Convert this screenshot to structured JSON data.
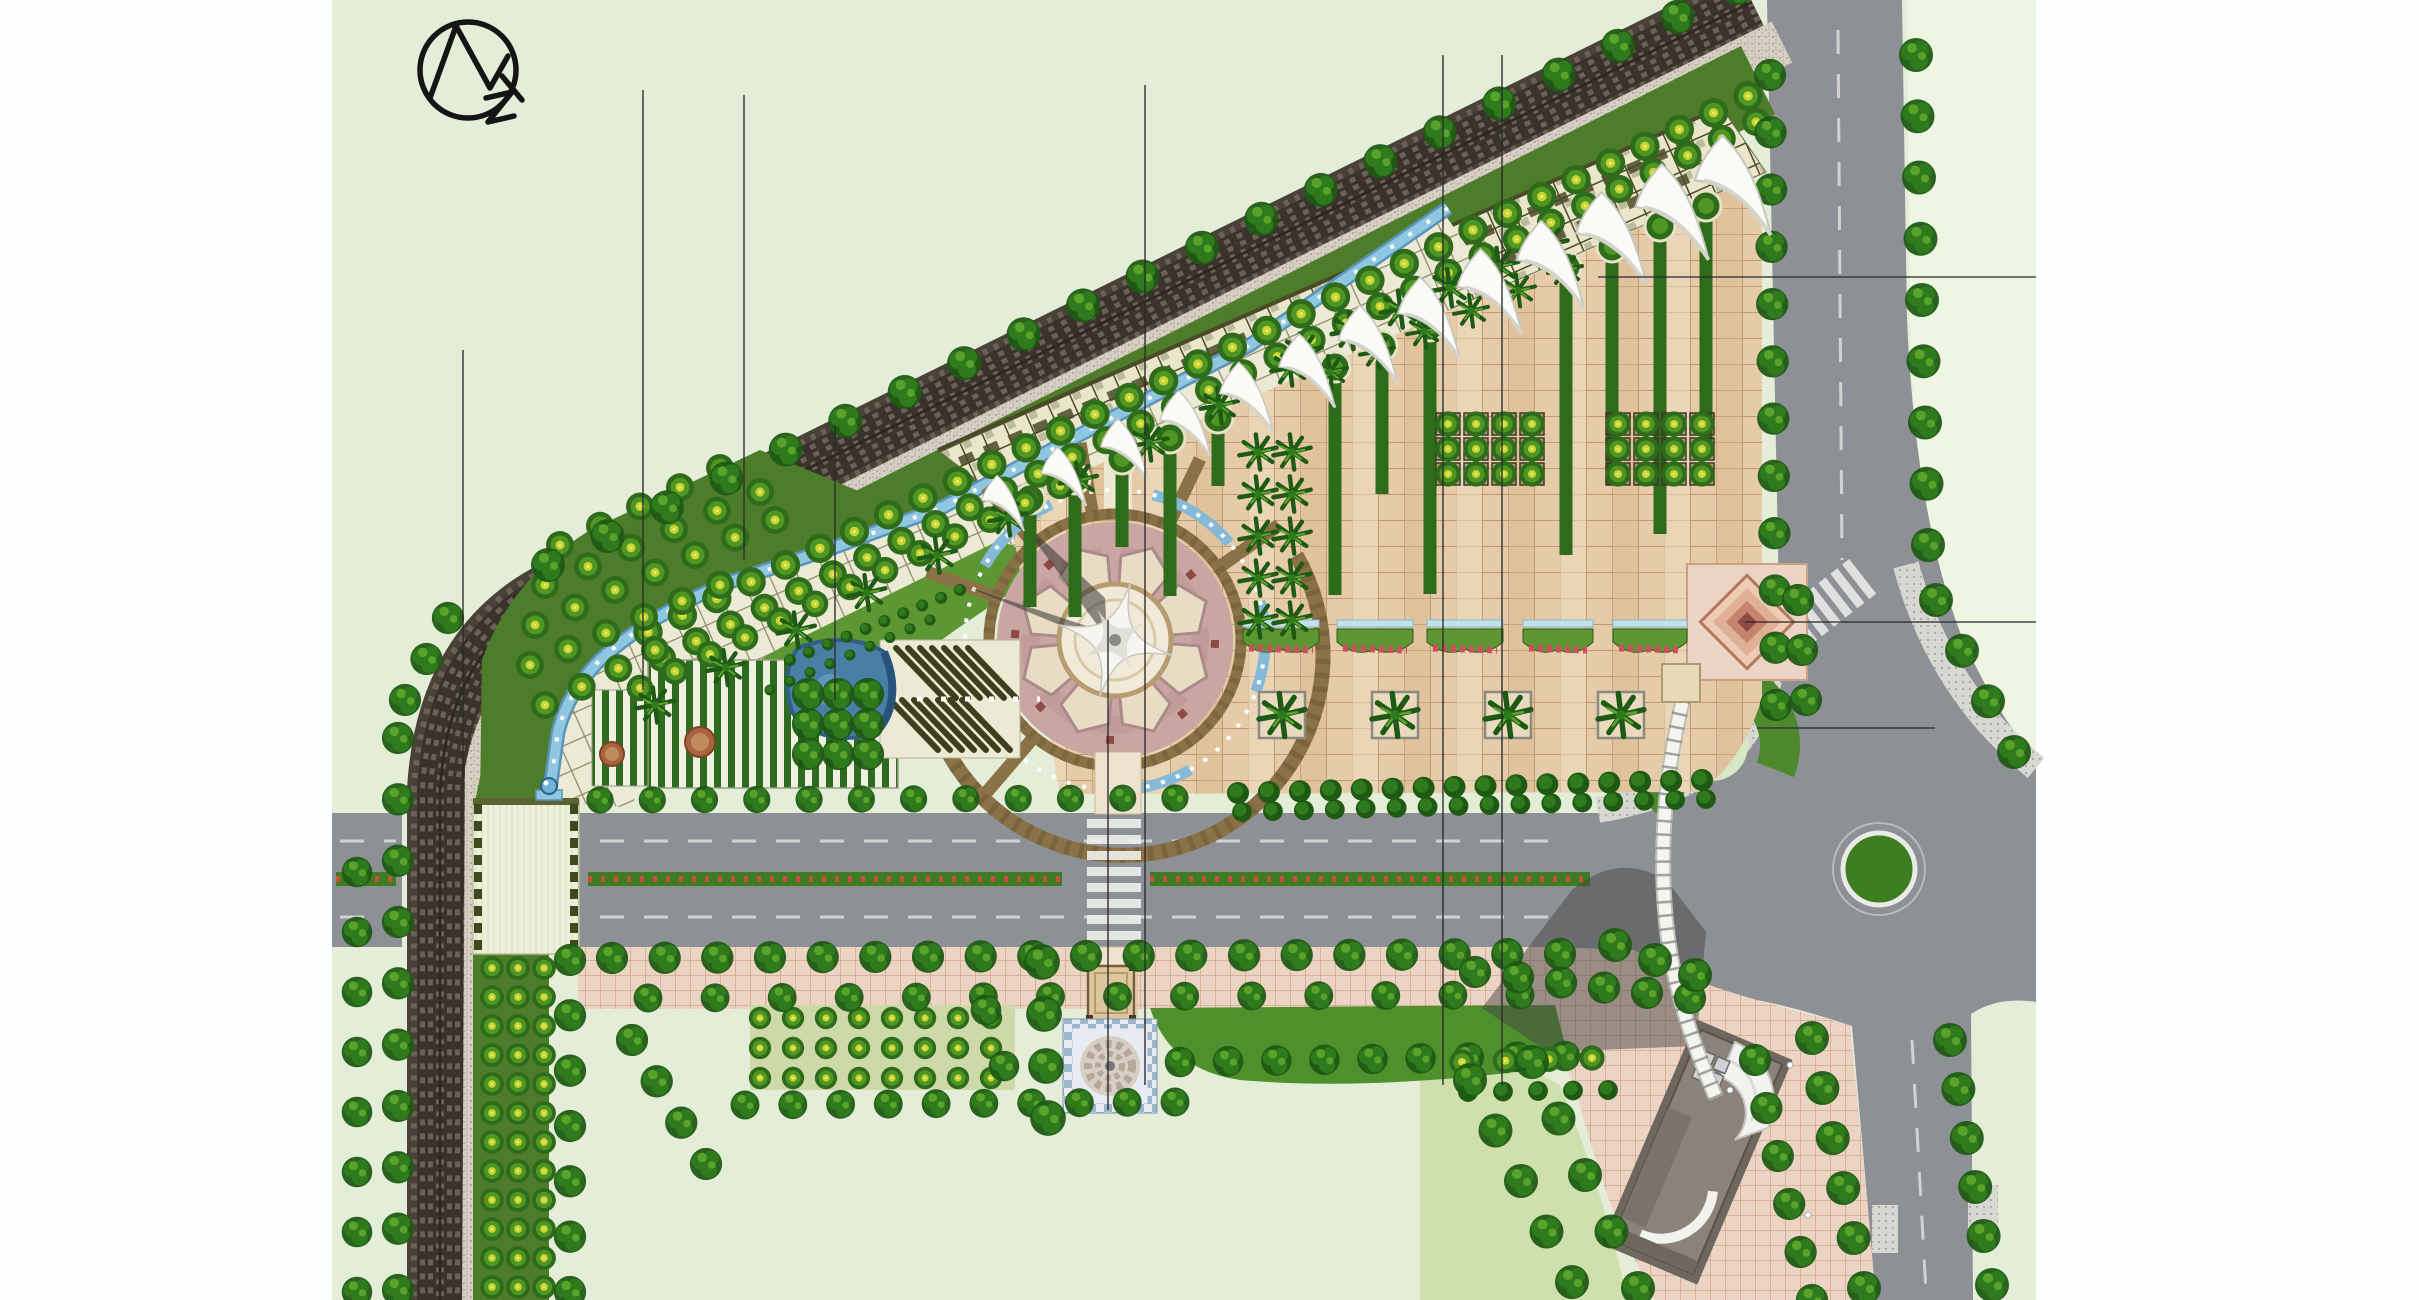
{
  "title": "park-landscape-master-plan",
  "north_arrow": {
    "name": "north-compass-logo"
  },
  "colors": {
    "bg": "#e4edd8",
    "bglight": "#eef5e3",
    "white": "#fdfeff",
    "road": "#8d9094",
    "roadline": "#e9e9e6",
    "raildark": "#4a4138",
    "railmid": "#6e6457",
    "railline": "#322c25",
    "gravel": "#d6d0c4",
    "lawn": "#4d7c2b",
    "lawnlight": "#5d9733",
    "lawnpale": "#cfe0ad",
    "tree1": "#1f5a14",
    "tree2": "#2f7a1c",
    "tree3": "#59a32b",
    "otree1": "#2e6b1a",
    "otree2": "#4f9625",
    "otreecore": "#c8d430",
    "trellisbg": "#eae6cc",
    "trellisline": "#4b4a28",
    "orange": "#c8803e",
    "stream": "#8fc6e0",
    "streamdeep": "#5b94ba",
    "espl": "#e5cba8",
    "esplline": "#c09a72",
    "pinkpave": "#ecd4c4",
    "pinkline": "#d2a78b",
    "plaza": "#c9a6a2",
    "plazacream": "#e8dcc4",
    "plazawhite": "#f2ead9",
    "ringbrown": "#8a7246",
    "dkred": "#8e4a44",
    "diamond1": "#f0cbb4",
    "diamond2": "#c5846b",
    "pond": "#4a7fa5",
    "ponddeep": "#2f5f86",
    "bldg": "#8b8379",
    "bldgdark": "#6e675e",
    "shadow": "#454545",
    "canopyglass": "#bfe2ec",
    "flower": "#cc4f5e",
    "medianred": "#c94f43",
    "ink": "#2b2b2b"
  },
  "features": {
    "tree_rows": [
      [
        648,
        632,
        1748,
        96,
        33,
        1.05,
        "otree"
      ],
      [
        662,
        658,
        1756,
        122,
        33,
        1.0,
        "otree"
      ],
      [
        640,
        688,
        1060,
        486,
        13,
        0.95,
        "otree"
      ],
      [
        560,
        545,
        720,
        468,
        5,
        1,
        "otree"
      ],
      [
        545,
        585,
        760,
        492,
        6,
        1,
        "otree"
      ],
      [
        535,
        625,
        775,
        520,
        7,
        1,
        "otree"
      ],
      [
        530,
        665,
        720,
        585,
        6,
        1,
        "otree"
      ],
      [
        545,
        705,
        655,
        650,
        4,
        1,
        "otree"
      ],
      [
        1737,
        -12,
        548,
        565,
        21,
        1,
        "tree"
      ],
      [
        448,
        618,
        405,
        700,
        3,
        0.95,
        "tree"
      ],
      [
        398,
        738,
        398,
        1290,
        10,
        0.95,
        "tree"
      ],
      [
        357,
        872,
        357,
        1292,
        8,
        0.9,
        "tree"
      ],
      [
        600,
        800,
        1175,
        798,
        12,
        0.8,
        "tree"
      ],
      [
        1238,
        793,
        1702,
        780,
        16,
        1,
        "shrub"
      ],
      [
        1242,
        812,
        1706,
        799,
        16,
        0.9,
        "shrub"
      ],
      [
        612,
        958,
        1560,
        954,
        19,
        0.95,
        "tree"
      ],
      [
        648,
        998,
        1520,
        995,
        14,
        0.85,
        "tree"
      ],
      [
        1180,
        1062,
        1565,
        1056,
        9,
        0.9,
        "tree"
      ],
      [
        745,
        1105,
        1175,
        1102,
        10,
        0.85,
        "tree"
      ],
      [
        632,
        1040,
        706,
        1164,
        4,
        0.95,
        "tree"
      ],
      [
        570,
        960,
        570,
        1292,
        7,
        0.95,
        "tree"
      ],
      [
        1042,
        962,
        1048,
        1118,
        4,
        1.05,
        "tree"
      ],
      [
        986,
        1010,
        1004,
        1066,
        2,
        0.9,
        "tree"
      ],
      [
        1770,
        75,
        1776,
        705,
        12,
        0.95,
        "tree"
      ],
      [
        1916,
        55,
        1928,
        545,
        9,
        1,
        "tree"
      ],
      [
        1936,
        600,
        2014,
        752,
        4,
        1,
        "tree"
      ],
      [
        1950,
        1040,
        1992,
        1285,
        6,
        1,
        "tree"
      ],
      [
        1812,
        1038,
        1864,
        1288,
        6,
        1,
        "tree"
      ],
      [
        1755,
        1060,
        1812,
        1300,
        6,
        0.95,
        "tree"
      ],
      [
        1475,
        972,
        1690,
        998,
        6,
        0.95,
        "tree"
      ],
      [
        1462,
        1062,
        1592,
        1058,
        4,
        0.9,
        "otree"
      ],
      [
        1468,
        1092,
        1608,
        1090,
        5,
        0.9,
        "shrub"
      ],
      [
        1470,
        1080,
        1572,
        1282,
        5,
        1,
        "tree"
      ],
      [
        1532,
        1062,
        1638,
        1288,
        5,
        1,
        "tree"
      ],
      [
        1798,
        600,
        1806,
        700,
        3,
        0.95,
        "tree"
      ],
      [
        1615,
        945,
        1695,
        975,
        3,
        1,
        "tree"
      ],
      [
        1302,
        352,
        1548,
        245,
        6,
        1.15,
        "palm"
      ],
      [
        1330,
        372,
        1565,
        270,
        6,
        1.0,
        "palm"
      ],
      [
        655,
        705,
        1290,
        368,
        10,
        1.1,
        "palm"
      ],
      [
        790,
        660,
        960,
        590,
        10,
        0.55,
        "shrub"
      ],
      [
        770,
        690,
        930,
        620,
        9,
        0.5,
        "shrub"
      ]
    ],
    "tree_grids": [
      {
        "x": 492,
        "y": 968,
        "cols": 3,
        "rows": 12,
        "dx": 26,
        "dy": 29,
        "s": 0.85,
        "sym": "otree",
        "frame": false
      },
      {
        "x": 808,
        "y": 694,
        "cols": 3,
        "rows": 3,
        "dx": 30,
        "dy": 30,
        "s": 0.95,
        "sym": "tree",
        "frame": false
      },
      {
        "x": 1258,
        "y": 452,
        "cols": 2,
        "rows": 5,
        "dx": 34,
        "dy": 42,
        "s": 1.1,
        "sym": "palm",
        "frame": false
      },
      {
        "x": 1448,
        "y": 424,
        "cols": 4,
        "rows": 3,
        "dx": 28,
        "dy": 25,
        "s": 0.9,
        "sym": "otree",
        "frame": true
      },
      {
        "x": 1618,
        "y": 424,
        "cols": 4,
        "rows": 3,
        "dx": 28,
        "dy": 25,
        "s": 0.9,
        "sym": "otree",
        "frame": true
      },
      {
        "x": 760,
        "y": 1018,
        "cols": 8,
        "rows": 3,
        "dx": 33,
        "dy": 30,
        "s": 0.8,
        "sym": "otree",
        "frame": false
      }
    ],
    "hedge_strips": [
      {
        "x": 1030,
        "y": 487,
        "len": 120
      },
      {
        "x": 1075,
        "y": 467,
        "len": 150
      },
      {
        "x": 1122,
        "y": 447,
        "len": 100
      },
      {
        "x": 1170,
        "y": 426,
        "len": 170
      },
      {
        "x": 1218,
        "y": 406,
        "len": 80
      },
      {
        "x": 1335,
        "y": 355,
        "len": 240
      },
      {
        "x": 1382,
        "y": 334,
        "len": 160
      },
      {
        "x": 1430,
        "y": 314,
        "len": 280
      },
      {
        "x": 1566,
        "y": 255,
        "len": 300
      },
      {
        "x": 1612,
        "y": 235,
        "len": 250
      },
      {
        "x": 1660,
        "y": 214,
        "len": 320
      },
      {
        "x": 1706,
        "y": 194,
        "len": 260
      }
    ],
    "flower_beds": [
      {
        "x": 1243,
        "w": 76
      },
      {
        "x": 1337,
        "w": 76
      },
      {
        "x": 1427,
        "w": 76
      },
      {
        "x": 1523,
        "w": 70
      },
      {
        "x": 1613,
        "w": 74
      }
    ],
    "palm_planters": [
      1282,
      1395,
      1508,
      1621
    ],
    "sails": {
      "x1": 1008,
      "y1": 500,
      "x2": 1742,
      "y2": 180,
      "n": 13,
      "rot": -24,
      "s0": 0.75,
      "ds": 0.05
    },
    "survey_lines": [
      [
        463,
        350,
        463,
        900
      ],
      [
        643,
        90,
        643,
        690
      ],
      [
        744,
        95,
        744,
        560
      ],
      [
        835,
        425,
        835,
        700
      ],
      [
        1108,
        620,
        1108,
        1110
      ],
      [
        1145,
        85,
        1145,
        1085
      ],
      [
        1443,
        55,
        1443,
        1085
      ],
      [
        1502,
        55,
        1502,
        1085
      ],
      [
        1598,
        277,
        2036,
        277
      ],
      [
        1745,
        622,
        2036,
        622
      ],
      [
        1757,
        728,
        1935,
        728
      ]
    ]
  }
}
